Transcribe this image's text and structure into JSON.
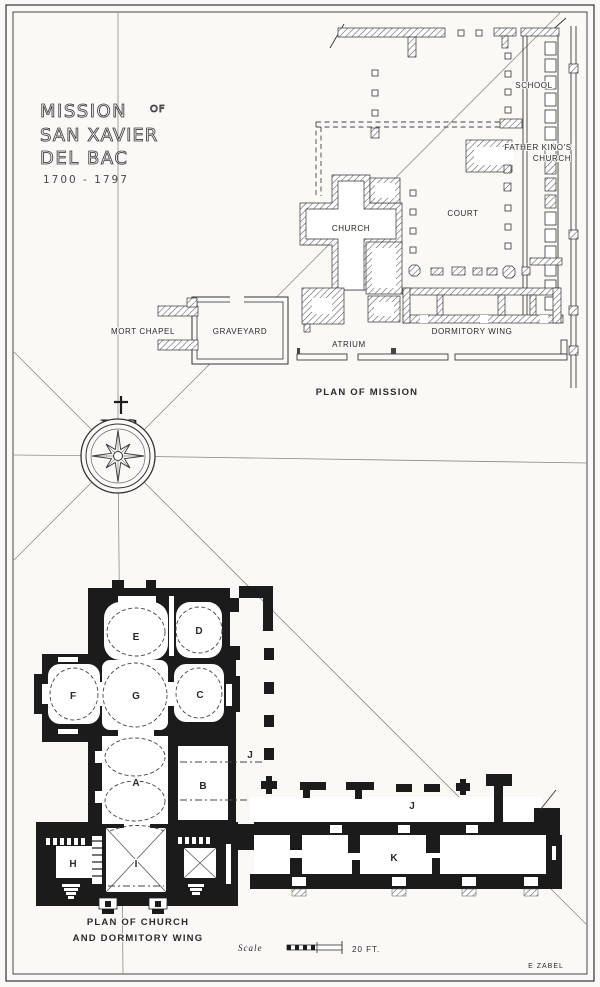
{
  "title": {
    "word1": "MISSION",
    "of": "OF",
    "line2": "SAN XAVIER",
    "line3": "DEL BAC",
    "dates": "1700 - 1797"
  },
  "compass": {
    "monogram": "JHS"
  },
  "mission_plan": {
    "caption": "PLAN OF MISSION",
    "labels": {
      "school": "SCHOOL",
      "father_kinos_line1": "FATHER  KINO'S",
      "father_kinos_line2": "CHURCH",
      "church": "CHURCH",
      "court": "COURT",
      "atrium": "ATRIUM",
      "dormitory_wing": "DORMITORY  WING",
      "mort_chapel": "MORT  CHAPEL",
      "graveyard": "GRAVEYARD"
    }
  },
  "church_plan": {
    "caption_line1": "PLAN OF CHURCH",
    "caption_line2": "AND DORMITORY WING",
    "rooms": {
      "a": "A",
      "b": "B",
      "c": "C",
      "d": "D",
      "e": "E",
      "f": "F",
      "g": "G",
      "h": "H",
      "i": "I",
      "j_west": "J",
      "j_south": "J",
      "k": "K"
    }
  },
  "scale_bar": {
    "label": "Scale",
    "value": "20 FT."
  },
  "signature": "E ZABEL"
}
